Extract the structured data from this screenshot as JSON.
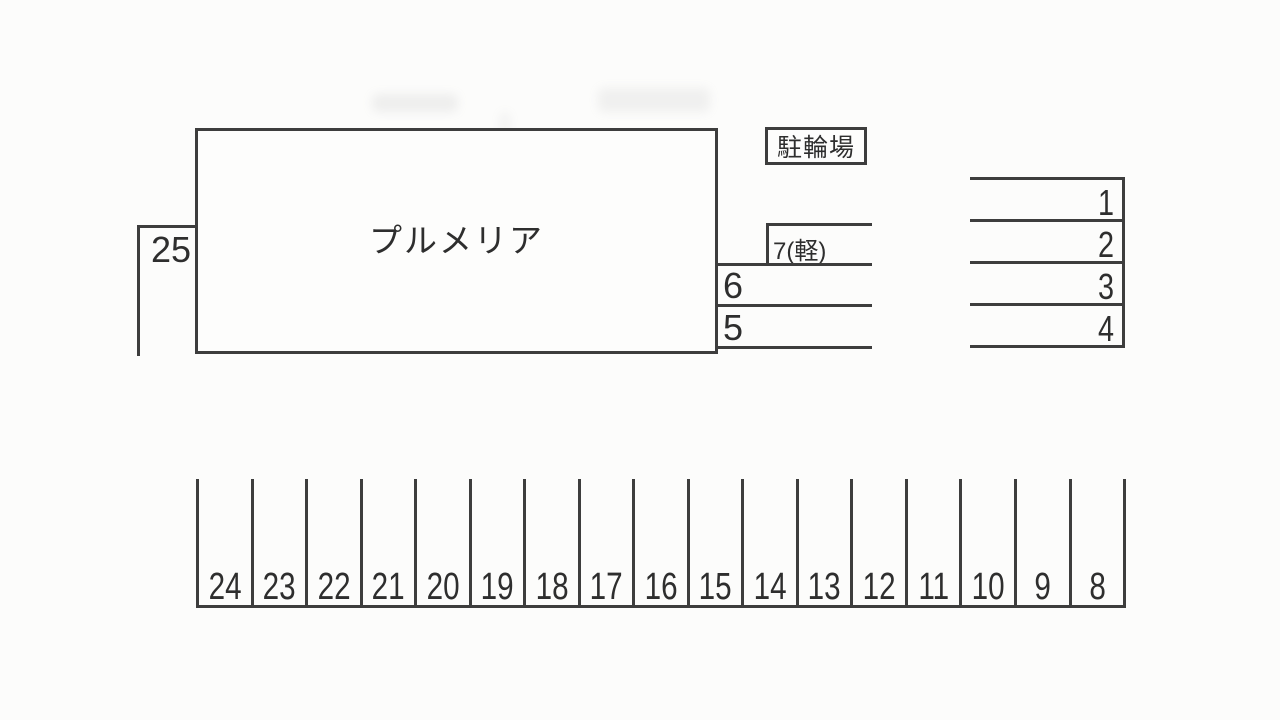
{
  "title": "駐車場配置図",
  "colors": {
    "line": "#3d3d3d",
    "text": "#2e2e2e",
    "background": "#fcfcfb"
  },
  "building": {
    "label": "プルメリア"
  },
  "bike_shed": {
    "label": "駐輪場"
  },
  "space_25": {
    "label": "25"
  },
  "side_column": {
    "space_7": "7(軽)",
    "space_6": "6",
    "space_5": "5"
  },
  "right_spaces": [
    "1",
    "2",
    "3",
    "4"
  ],
  "bottom_spaces": [
    "24",
    "23",
    "22",
    "21",
    "20",
    "19",
    "18",
    "17",
    "16",
    "15",
    "14",
    "13",
    "12",
    "11",
    "10",
    "9",
    "8"
  ]
}
